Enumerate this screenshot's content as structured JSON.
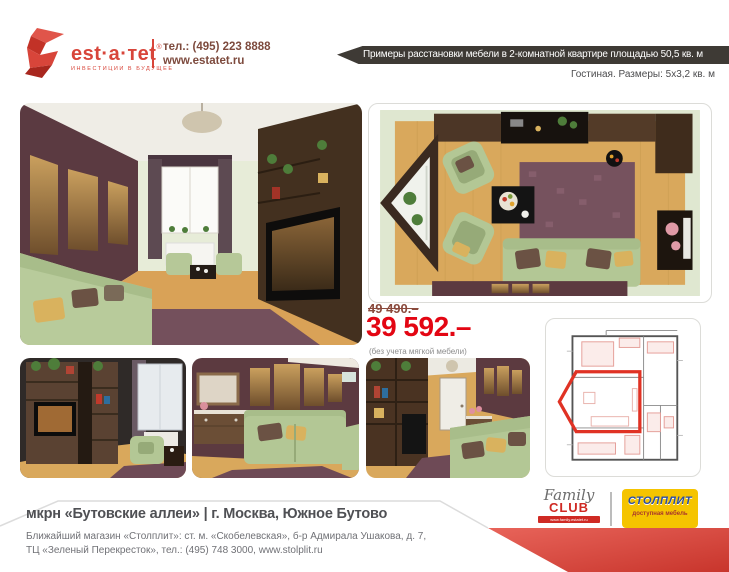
{
  "header": {
    "logo": {
      "name": "est·a·тet",
      "trademark": "®",
      "tagline": "ИНВЕСТИЦИИ В БУДУЩЕЕ"
    },
    "contact": {
      "phone": "тел.: (495) 223 8888",
      "website": "www.estatet.ru"
    }
  },
  "banner": {
    "title": "Примеры расстановки мебели в 2-комнатной квартире площадью 50,5 кв. м",
    "subtitle": "Гостиная. Размеры: 5x3,2 кв. м"
  },
  "offer": {
    "old_price": "49 490.–",
    "new_price": "39 592.–",
    "note": "(без учета мягкой мебели)"
  },
  "footer": {
    "title": "мкрн «Бутовские аллеи» | г. Москва, Южное Бутово",
    "address_line1": "Ближайший магазин «Столплит»: ст. м. «Скобелевская», б-р Адмирала Ушакова, д. 7,",
    "address_line2": "ТЦ «Зеленый Перекресток», тел.: (495) 748 3000, www.stolplit.ru"
  },
  "partners": {
    "family_club": {
      "script": "Family",
      "caps": "CLUB",
      "url": "www.family.estatet.ru"
    },
    "stolplit": {
      "name": "СТОЛПЛИТ",
      "subtitle": "доступная мебель"
    }
  },
  "colors": {
    "brand_red": "#d8453a",
    "price_red": "#e30613",
    "old_price_brown": "#8a4a3c",
    "banner_dark": "#3e3a35",
    "ribbon_red": "#cf3a31",
    "stolplit_yellow": "#f5c400",
    "stolplit_blue": "#2b4ea2",
    "footer_gray": "#4f5054"
  }
}
